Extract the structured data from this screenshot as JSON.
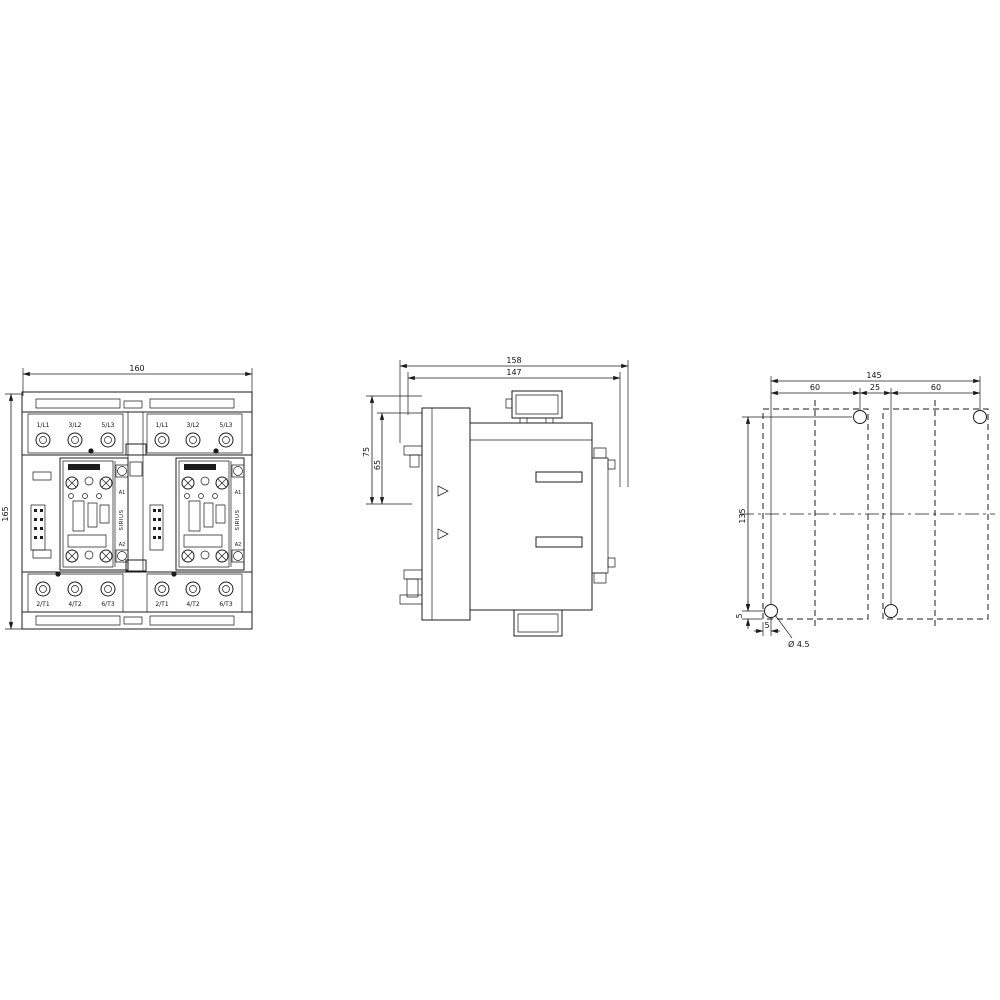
{
  "colors": {
    "line": "#1c1c1c",
    "background": "#ffffff"
  },
  "views": {
    "front": {
      "dims": {
        "width": "160",
        "height": "165"
      },
      "terminals": {
        "top": [
          "1/L1",
          "3/L2",
          "5/L3",
          "1/L1",
          "3/L2",
          "5/L3"
        ],
        "bottom": [
          "2/T1",
          "4/T2",
          "6/T3",
          "2/T1",
          "4/T2",
          "6/T3"
        ]
      },
      "contactor_left": {
        "brand": "SIRIUS",
        "coil_top": "A1",
        "coil_bottom": "A2"
      },
      "contactor_right": {
        "brand": "SIRIUS",
        "coil_top": "A1",
        "coil_bottom": "A2"
      }
    },
    "side": {
      "dims": {
        "depth_outer": "158",
        "depth_inner": "147",
        "front_outer": "75",
        "front_inner": "65"
      }
    },
    "drill": {
      "dims": {
        "total_width": "145",
        "left_span": "60",
        "center_span": "25",
        "right_span": "60",
        "height": "135",
        "edge_offset_vertical": "5",
        "edge_offset_horizontal": "5",
        "hole_callout": "Ø 4.5"
      }
    }
  }
}
